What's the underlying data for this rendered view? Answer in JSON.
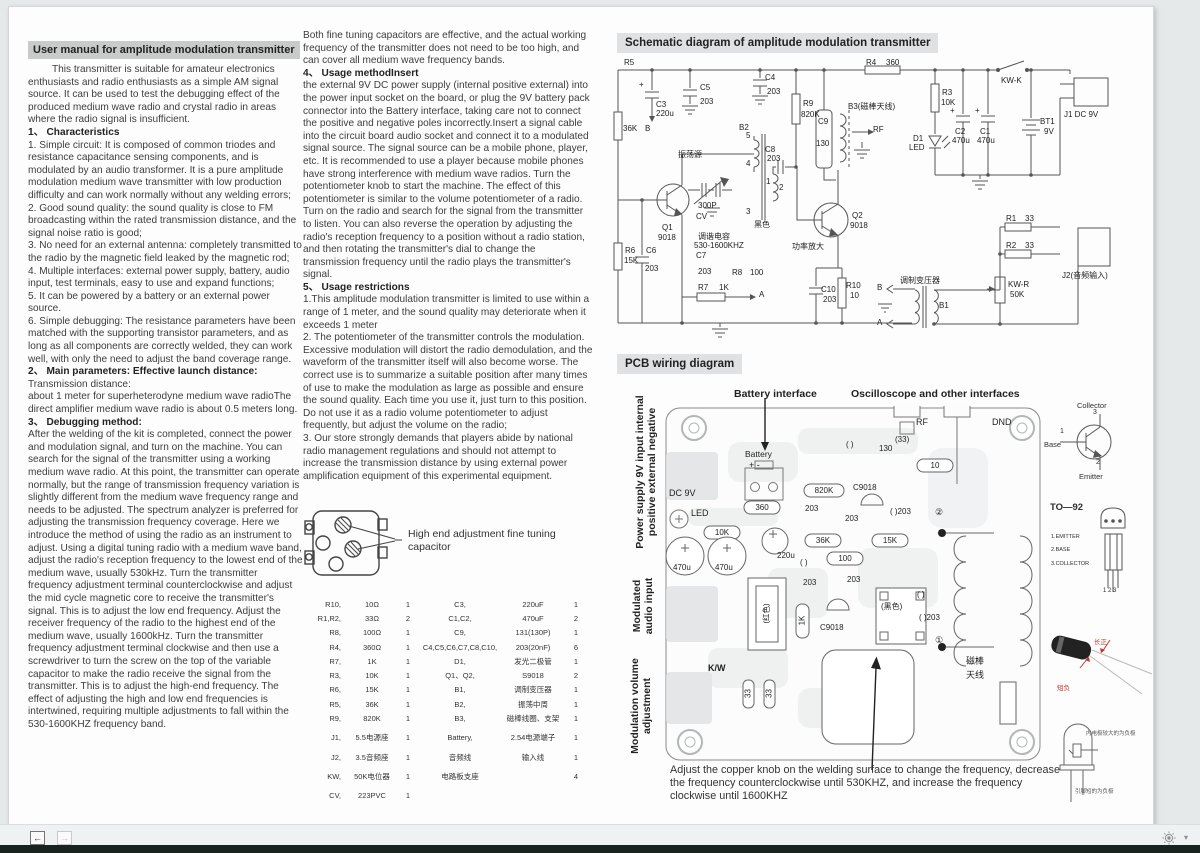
{
  "chrome": {
    "back_icon": "←",
    "forward_icon": "→",
    "caret_icon": "▾"
  },
  "left": {
    "title": "User manual for amplitude modulation transmitter",
    "intro": "This transmitter is suitable for amateur electronics enthusiasts and radio enthusiasts as a simple AM signal source. It can be used to test the debugging effect of the produced medium wave radio and crystal radio in areas where the radio signal is insufficient.",
    "h1": "1、 Characteristics",
    "c1": "1. Simple circuit: It is composed of common triodes and resistance capacitance sensing components, and is modulated by an audio transformer. It is a pure amplitude modulation medium wave transmitter with low production difficulty and can work normally without any welding errors;",
    "c2": "2. Good sound quality: the sound quality is close to FM broadcasting within the rated transmission distance, and the signal noise ratio is good;",
    "c3": "3. No need for an external antenna: completely transmitted to the radio by the magnetic field leaked by the magnetic rod;",
    "c4": "4. Multiple interfaces: external power supply, battery, audio input, test terminals, easy to use and expand functions;",
    "c5": "5. It can be powered by a battery or an external power source.",
    "c6": "6. Simple debugging: The resistance parameters have been matched with the supporting transistor parameters, and as long as all components are correctly welded, they can work well, with only the need to adjust the band coverage range.",
    "h2": "2、 Main parameters: Effective launch distance:",
    "p2a": " Transmission distance:",
    "p2b": "about 1 meter for superheterodyne medium wave radioThe direct amplifier medium wave radio is about 0.5 meters long.",
    "h3": "3、 Debugging method:",
    "p3": "After the welding of the kit is completed, connect the power and modulation signal, and turn on the machine. You can search for the signal of the transmitter using a working medium wave radio. At this point, the transmitter can operate normally, but the range of transmission frequency variation is slightly different from the medium wave frequency range and needs to be adjusted. The spectrum analyzer is preferred for adjusting the transmission frequency coverage. Here we introduce the method of using the radio as an instrument to adjust. Using a digital tuning radio with a medium wave band, adjust the radio's reception frequency to the lowest end of the medium wave, usually 530kHz. Turn the transmitter frequency adjustment terminal counterclockwise and adjust the mid cycle magnetic core to receive the transmitter's signal. This is to adjust the low end frequency. Adjust the receiver frequency of the radio to the highest end of the medium wave, usually 1600kHz. Turn the transmitter frequency adjustment terminal clockwise and then use a screwdriver to turn the screw on the top of the variable capacitor to make the radio receive the signal from the transmitter. This is to adjust the high-end frequency. The effect of adjusting the high and low end frequencies is intertwined, requiring multiple adjustments to fall within the 530-1600KHZ frequency band."
  },
  "middle": {
    "p0": "Both fine tuning capacitors are effective, and the actual working frequency of the transmitter does not need to be too high, and can cover all medium wave frequency bands.",
    "h4": "4、 Usage methodInsert",
    "p4": "the external 9V DC power supply (internal positive external) into the power input socket on the board, or plug the 9V battery pack connector into the Battery interface, taking care not to connect the positive and negative poles incorrectly.Insert a signal cable into the circuit board audio socket and connect it to a modulated signal source. The signal source can be a mobile phone, player, etc. It is recommended to use a player because mobile phones have strong interference with medium wave radios. Turn the potentiometer knob to start the machine. The effect of this potentiometer is similar to the volume potentiometer of a radio. Turn on the radio and search for the signal from the transmitter to listen. You can also reverse the operation by adjusting the radio's reception frequency to a position without a radio station, and then rotating the transmitter's dial to change the transmission frequency until the radio plays the transmitter's signal.",
    "h5": "5、 Usage restrictions",
    "r1": "1.This amplitude modulation transmitter is limited to use within a range of 1 meter, and the sound quality may deteriorate when it exceeds 1 meter",
    "r2": "2. The potentiometer of the transmitter controls the modulation. Excessive modulation will distort the radio demodulation, and the waveform of the transmitter itself will also become worse. The correct use is to summarize a suitable position after many times of use to make the modulation as large as possible and ensure the sound quality. Each time you use it, just turn to this position. Do not use it as a radio volume potentiometer to adjust frequently, but adjust the volume on the radio;",
    "r3": "3. Our store strongly demands that players abide by national radio management regulations and should not attempt to increase the transmission distance by using external power amplification equipment of this experimental equipment."
  },
  "trimmer_callout": "High end adjustment fine tuning capacitor",
  "parts_rows": [
    [
      "R10,",
      "10Ω",
      "1",
      "C3,",
      "220uF",
      "1"
    ],
    [
      "R1,R2,",
      "33Ω",
      "2",
      "C1,C2,",
      "470uF",
      "2"
    ],
    [
      "R8,",
      "100Ω",
      "1",
      "C9,",
      "131(130P)",
      "1"
    ],
    [
      "R4,",
      "360Ω",
      "1",
      "C4,C5,C6,C7,C8,C10,",
      "203(20nF)",
      "6"
    ],
    [
      "R7,",
      "1K",
      "1",
      "D1,",
      "发光二极管",
      "1"
    ],
    [
      "R3,",
      "10K",
      "1",
      "Q1、Q2,",
      "S9018",
      "2"
    ],
    [
      "R6,",
      "15K",
      "1",
      "B1,",
      "调制变压器",
      "1"
    ],
    [
      "R5,",
      "36K",
      "1",
      "B2,",
      "振荡中周",
      "1"
    ],
    [
      "R9,",
      "820K",
      "1",
      "B3,",
      "磁棒线圈、支架",
      "1"
    ],
    [
      "J1,",
      "5.5电源座",
      "1",
      "Battery,",
      "2.54电源端子",
      "1"
    ],
    [
      "J2,",
      "3.5音频座",
      "1",
      "音频线",
      "输入线",
      "1"
    ],
    [
      "KW,",
      "50K电位器",
      "1",
      "电路板支座",
      "",
      "4"
    ],
    [
      "CV,",
      "223PVC",
      "1",
      "",
      "",
      ""
    ]
  ],
  "sch": {
    "title": "Schematic diagram of amplitude modulation transmitter",
    "plus": "+",
    "r4": "R4",
    "r4v": "360",
    "r5": "R5",
    "r5v": "36K",
    "r9": "R9",
    "r9v": "820K",
    "r3": "R3",
    "r3v": "10K",
    "r6": "R6",
    "r6v": "15K",
    "r7": "R7",
    "r7v": "1K",
    "r8": "R8",
    "r8v": "100",
    "r1": "R1",
    "r1v": "33",
    "r2": "R2",
    "r2v": "33",
    "r10": "R10",
    "r10v": "10",
    "c1": "C1",
    "c1v": "470u",
    "c2": "C2",
    "c2v": "470u",
    "c3": "C3",
    "c3v": "220u",
    "c4": "C4",
    "c4v": "203",
    "c5": "C5",
    "c5v": "203",
    "c6": "C6",
    "c6v": "203",
    "c7": "C7",
    "c7v": "203",
    "c8": "C8",
    "c8v": "203",
    "c9": "C9",
    "c9v": "130",
    "c10": "C10",
    "c10v": "203",
    "d1": "D1",
    "d1v": "LED",
    "bt1": "BT1",
    "bt1v": "9V",
    "q1": "Q1",
    "q1v": "9018",
    "q2": "Q2",
    "q2v": "9018",
    "b1": "B1",
    "b2": "B2",
    "b3": "B3(磁棒天线)",
    "kwk": "KW-K",
    "kwr": "KW-R",
    "kwrv": "50K",
    "j1": "J1 DC 9V",
    "j2": "J2(音频输入)",
    "cv300": "300P",
    "cv": "CV",
    "osc_src": "振荡源",
    "tune1": "调谐电容",
    "tune2": "530-1600KHZ",
    "black": "黑色",
    "amp": "功率放大",
    "modtr": "调制变压器",
    "mark_a": "A",
    "mark_b": "B",
    "rf": "RF",
    "p1": "1",
    "p2": "2",
    "p3": "3",
    "p4": "4",
    "p5": "5"
  },
  "pcb": {
    "title": "PCB wiring diagram",
    "battery_interface": "Battery interface",
    "osc_interfaces": "Oscilloscope and other interfaces",
    "rf": "RF",
    "dnd": "DND",
    "battery": "Battery",
    "plus_minus": "+  -",
    "dc9v": "DC 9V",
    "led": "LED",
    "r820k": "820K",
    "r360": "360",
    "r10k": "10K",
    "r36k": "36K",
    "r15k": "15K",
    "r100": "100",
    "r10": "10",
    "c9018": "C9018",
    "v130": "130",
    "par": "( )",
    "v33": "(33)",
    "v203": "203",
    "par203": "( )203",
    "n1": "①",
    "n2": "②",
    "v220u": "220u",
    "v470": "470u",
    "red": "(红色)",
    "black": "(黑色)",
    "v1k": "1K",
    "kw": "K/W",
    "v33s": "33",
    "rod1": "磁棒",
    "rod2": "天线",
    "side1": "Power supply 9V input internal positive external negative",
    "side2": "Modulated audio input",
    "side3": "Modulation volume adjustment",
    "note": "Adjust the copper knob on the welding surface to change the frequency, decrease the frequency counterclockwise until 530KHZ, and increase the frequency clockwise until 1600KHZ"
  },
  "trans": {
    "collector": "Collector",
    "base": "Base",
    "emitter": "Emitter",
    "n1": "1",
    "n2": "2",
    "n3": "3",
    "to92": "TO—92",
    "pin1": "1.EMITTER",
    "pin2": "2.BASE",
    "pin3": "3.COLLECTOR",
    "pins": "1 2 3"
  },
  "photos": {
    "cap_pos": "长正",
    "cap_neg": "短负",
    "led_top": "内电极较大的为负极",
    "led_bottom": "引脚短的为负极"
  }
}
